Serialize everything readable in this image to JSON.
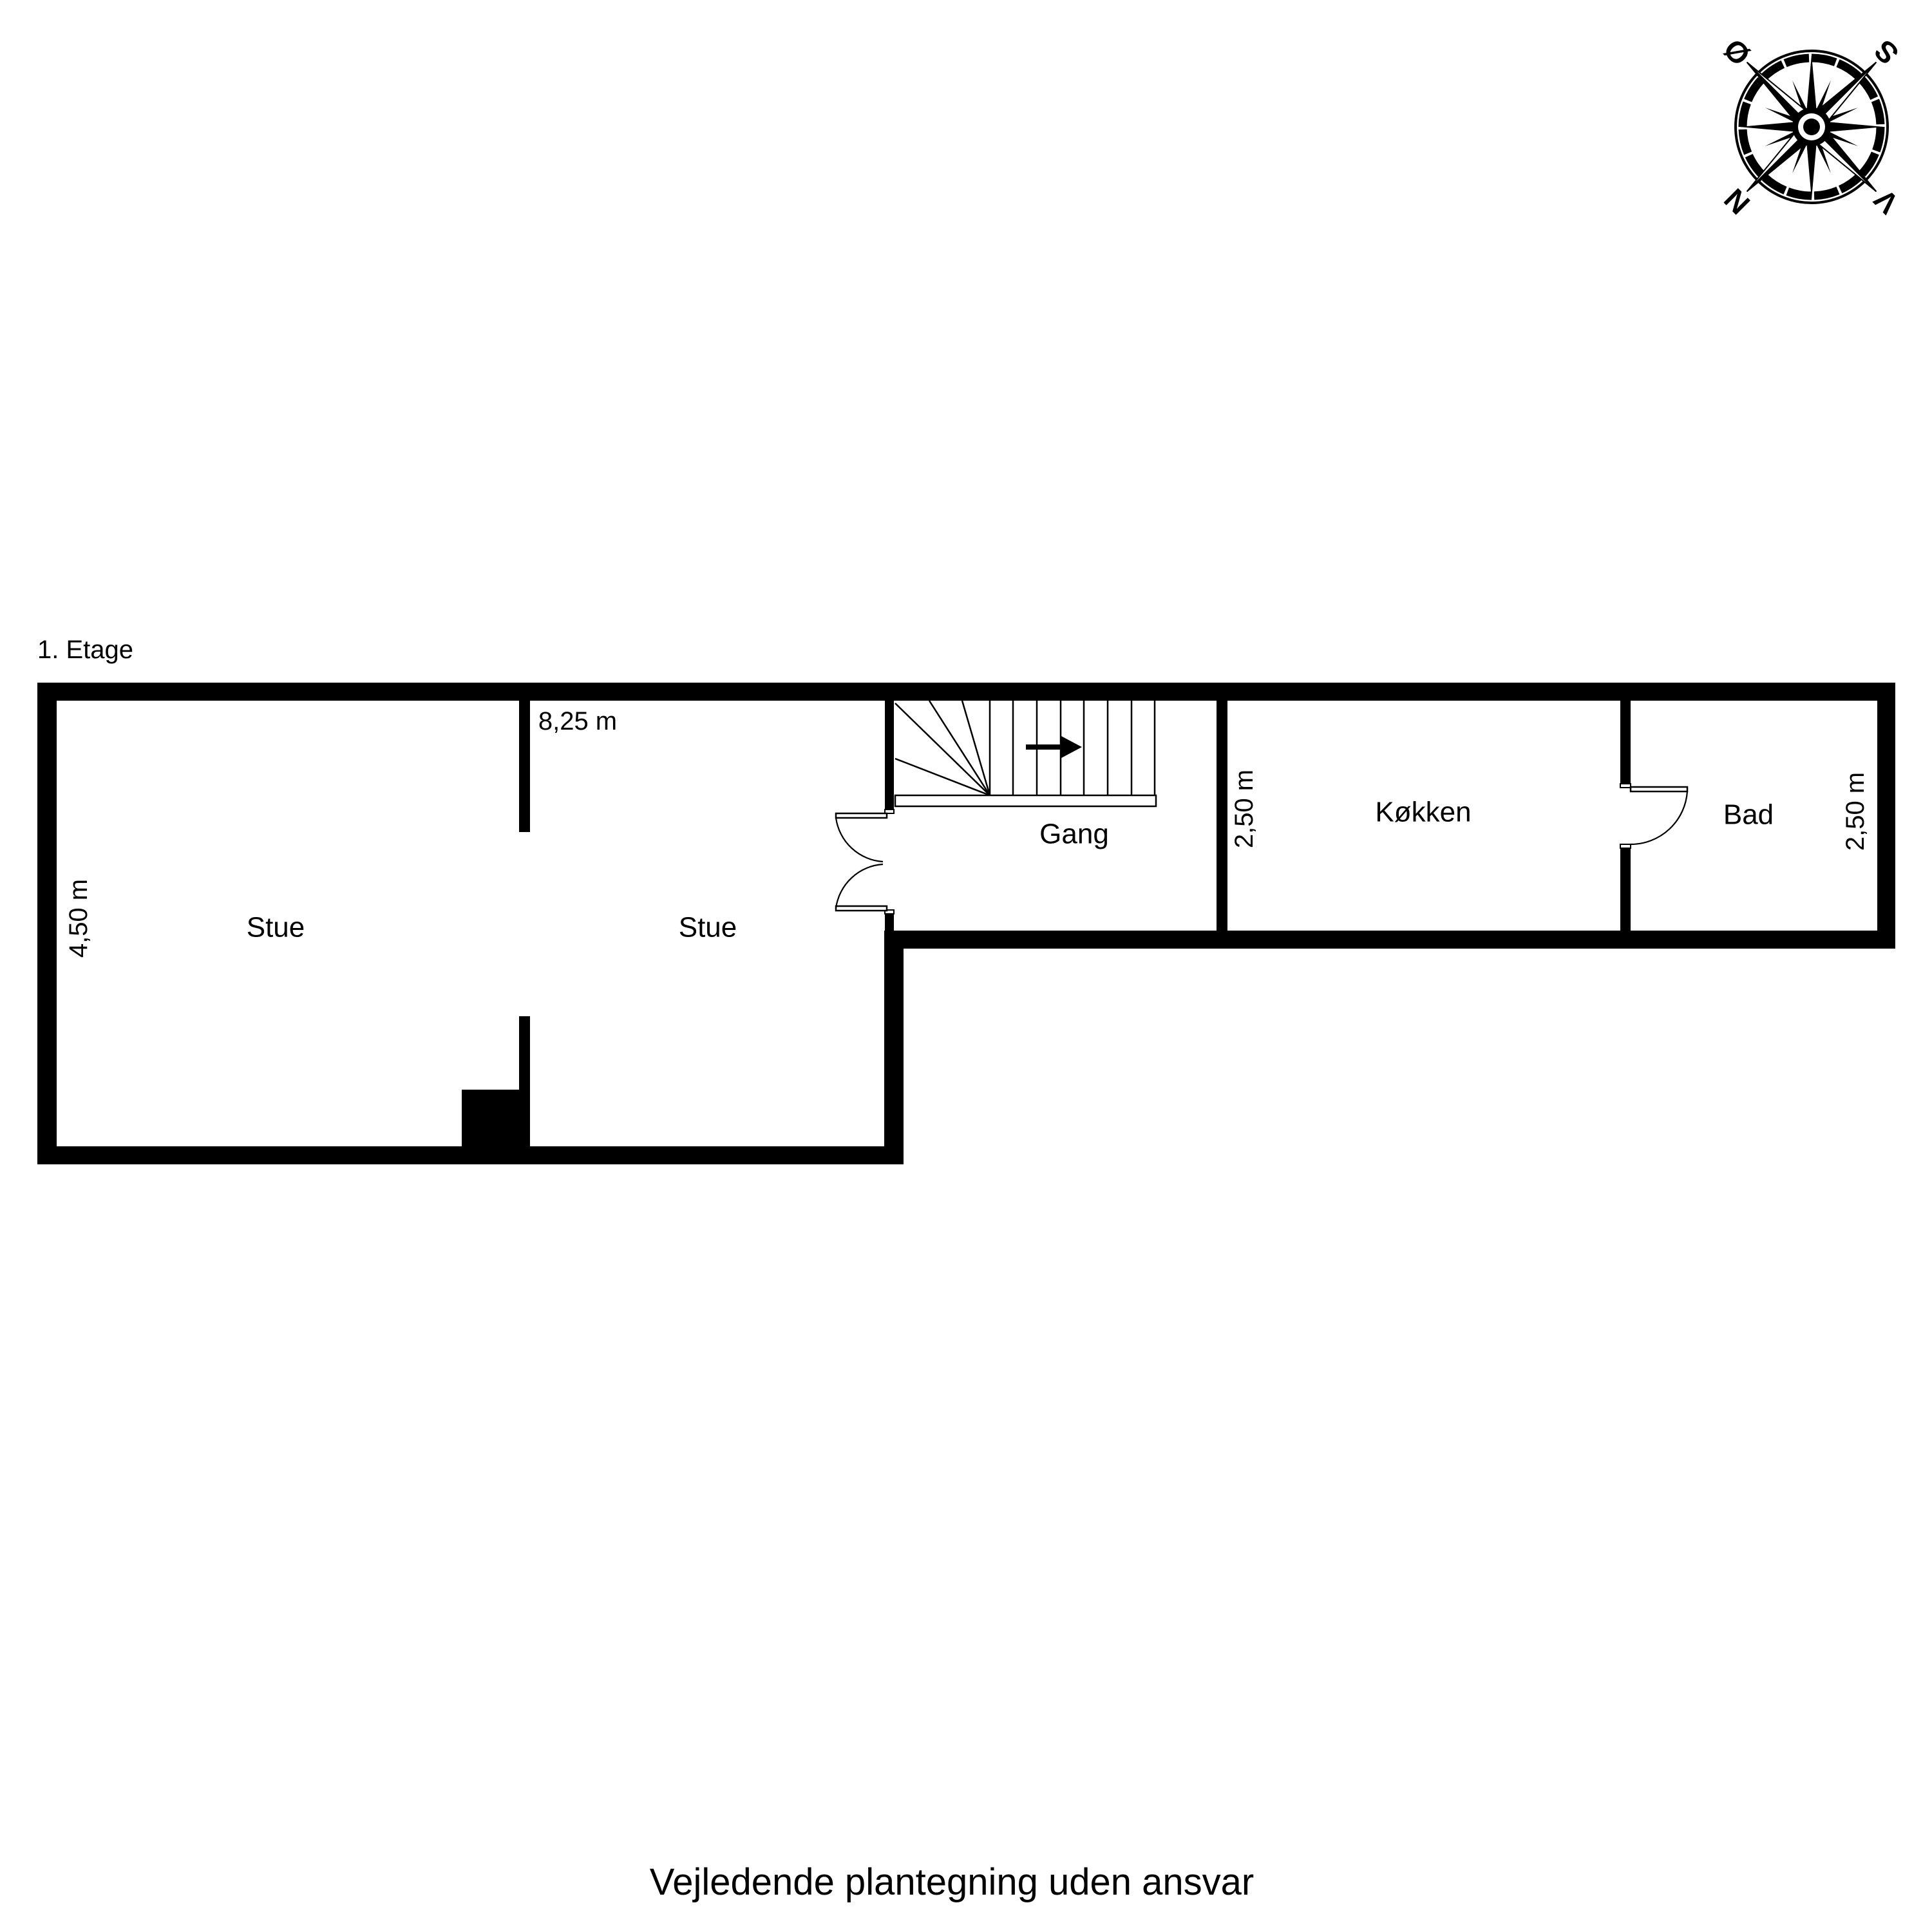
{
  "title": "1. Etage",
  "caption": "Vejledende plantegning uden ansvar",
  "compass": {
    "labels": {
      "north": "N",
      "east": "Ø",
      "south": "S",
      "west": "V"
    },
    "rotation_deg": 225
  },
  "rooms": {
    "stue1": {
      "label": "Stue"
    },
    "stue2": {
      "label": "Stue"
    },
    "gang": {
      "label": "Gang"
    },
    "koekken": {
      "label": "Køkken"
    },
    "bad": {
      "label": "Bad"
    }
  },
  "dimensions": {
    "stue_width": "8,25 m",
    "stue_height": "4,50 m",
    "koekken_height": "2,50 m",
    "bad_height": "2,50 m"
  },
  "colors": {
    "ink": "#000000",
    "background": "#ffffff"
  }
}
